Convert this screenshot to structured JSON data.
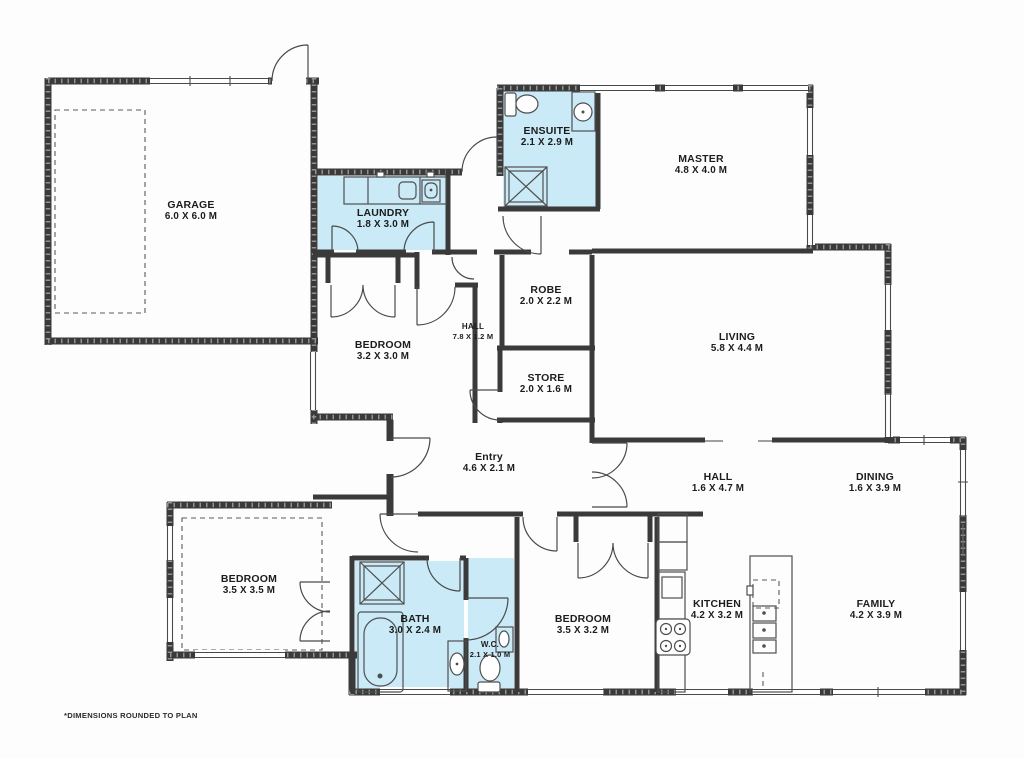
{
  "plan": {
    "note": "*DIMENSIONS ROUNDED TO PLAN",
    "colors": {
      "wet_area": "#c9eaf6",
      "wall": "#3a3a3a",
      "background": "#fdfdfd"
    },
    "rooms": [
      {
        "id": "garage",
        "name": "GARAGE",
        "dims": "6.0 X 6.0 M",
        "x": 191,
        "y": 199,
        "small": false
      },
      {
        "id": "laundry",
        "name": "LAUNDRY",
        "dims": "1.8 X 3.0 M",
        "x": 383,
        "y": 207,
        "small": false
      },
      {
        "id": "ensuite",
        "name": "ENSUITE",
        "dims": "2.1 X 2.9 M",
        "x": 547,
        "y": 125,
        "small": false
      },
      {
        "id": "master",
        "name": "MASTER",
        "dims": "4.8 X 4.0 M",
        "x": 701,
        "y": 153,
        "small": false
      },
      {
        "id": "robe",
        "name": "ROBE",
        "dims": "2.0 X 2.2 M",
        "x": 546,
        "y": 284,
        "small": false
      },
      {
        "id": "living",
        "name": "LIVING",
        "dims": "5.8 X 4.4 M",
        "x": 737,
        "y": 331,
        "small": false
      },
      {
        "id": "bedroom2",
        "name": "BEDROOM",
        "dims": "3.2 X 3.0 M",
        "x": 383,
        "y": 339,
        "small": false
      },
      {
        "id": "hall1",
        "name": "HALL",
        "dims": "7.8 X 1.2 M",
        "x": 473,
        "y": 322,
        "small": true
      },
      {
        "id": "store",
        "name": "STORE",
        "dims": "2.0 X 1.6 M",
        "x": 546,
        "y": 372,
        "small": false
      },
      {
        "id": "entry",
        "name": "Entry",
        "dims": "4.6 X 2.1 M",
        "x": 489,
        "y": 451,
        "small": false
      },
      {
        "id": "hall2",
        "name": "HALL",
        "dims": "1.6 X 4.7 M",
        "x": 718,
        "y": 471,
        "small": false
      },
      {
        "id": "dining",
        "name": "DINING",
        "dims": "1.6 X 3.9 M",
        "x": 875,
        "y": 471,
        "small": false
      },
      {
        "id": "bedroom3",
        "name": "BEDROOM",
        "dims": "3.5 X 3.5 M",
        "x": 249,
        "y": 573,
        "small": false
      },
      {
        "id": "bath",
        "name": "BATH",
        "dims": "3.0 X 2.4 M",
        "x": 415,
        "y": 613,
        "small": false
      },
      {
        "id": "wc",
        "name": "W.C.",
        "dims": "2.1 X 1.0 M",
        "x": 490,
        "y": 640,
        "small": true
      },
      {
        "id": "bedroom4",
        "name": "BEDROOM",
        "dims": "3.5 X 3.2 M",
        "x": 583,
        "y": 613,
        "small": false
      },
      {
        "id": "kitchen",
        "name": "KITCHEN",
        "dims": "4.2 X 3.2 M",
        "x": 717,
        "y": 598,
        "small": false
      },
      {
        "id": "family",
        "name": "FAMILY",
        "dims": "4.2 X 3.9 M",
        "x": 876,
        "y": 598,
        "small": false
      }
    ]
  }
}
